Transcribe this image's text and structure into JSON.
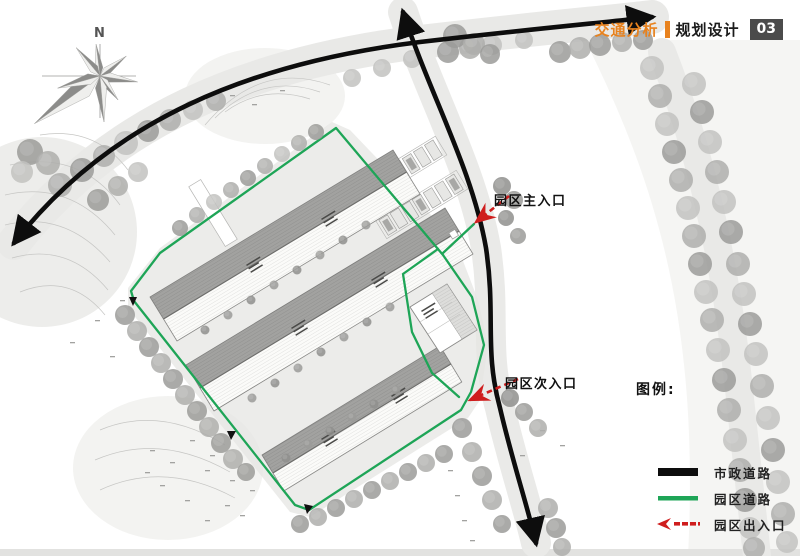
{
  "title": {
    "primary": "交通分析",
    "secondary": "规划设计",
    "page_number": "03"
  },
  "compass": {
    "label": "N"
  },
  "annotations": {
    "main_entrance": "园区主入口",
    "secondary_entrance": "园区次入口"
  },
  "legend": {
    "heading": "图例:",
    "items": [
      {
        "label": "市政道路",
        "type": "municipal-road",
        "color": "#0d0d0d"
      },
      {
        "label": "园区道路",
        "type": "park-road",
        "color": "#1ea557"
      },
      {
        "label": "园区出入口",
        "type": "park-entrance",
        "color": "#cf1d1d"
      }
    ]
  },
  "colors": {
    "accent_orange": "#e8821e",
    "park_road_green": "#1ea557",
    "entrance_red": "#cf1d1d",
    "municipal_road_black": "#0d0d0d"
  }
}
